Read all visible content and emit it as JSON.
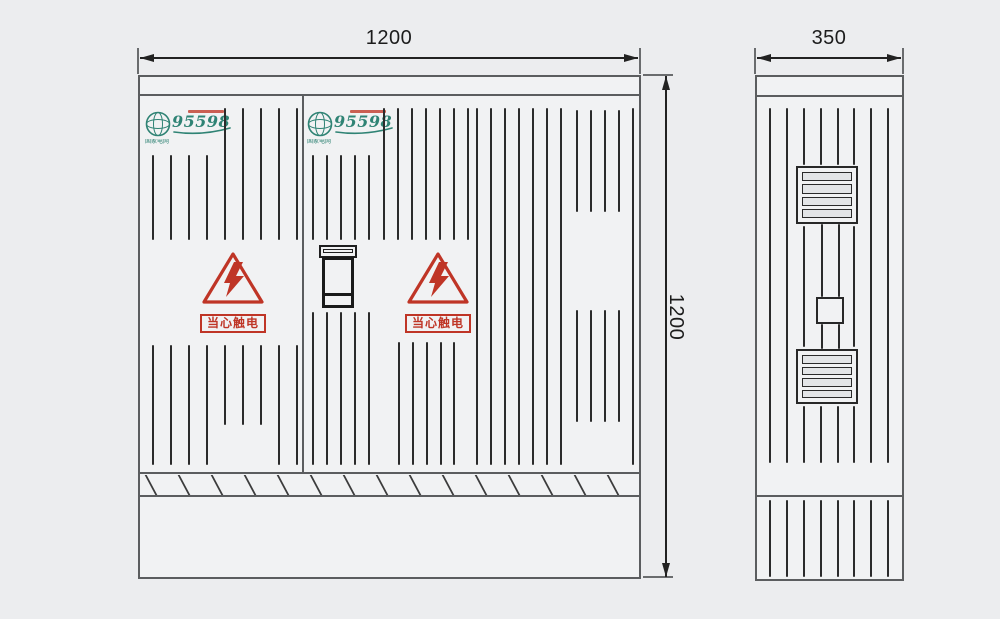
{
  "colors": {
    "background": "#ecedef",
    "panel_fill": "#f1f2f3",
    "line": "#3c3c3c",
    "slot": "#2b2b2b",
    "logo_teal": "#2f8374",
    "warning_red": "#bf3526",
    "dim_text": "#1c1c1c"
  },
  "dimensions": {
    "front_width": "1200",
    "front_height": "1200",
    "side_width": "350"
  },
  "logo": {
    "number": "95598",
    "brand": "国家电网"
  },
  "warning": {
    "text": "当心触电"
  },
  "front_view": {
    "slot_groups": [
      {
        "xs": [
          152,
          170,
          188,
          206
        ],
        "y1": 155,
        "y2": 240
      },
      {
        "xs": [
          224,
          242,
          260,
          278,
          296
        ],
        "y1": 108,
        "y2": 240
      },
      {
        "xs": [
          152,
          170,
          188,
          206
        ],
        "y1": 345,
        "y2": 465
      },
      {
        "xs": [
          224,
          242,
          260
        ],
        "y1": 345,
        "y2": 425
      },
      {
        "xs": [
          278,
          296
        ],
        "y1": 345,
        "y2": 465
      },
      {
        "xs": [
          312,
          326,
          340,
          354,
          368
        ],
        "y1": 155,
        "y2": 240
      },
      {
        "xs": [
          312,
          326,
          340,
          354,
          368
        ],
        "y1": 312,
        "y2": 465
      },
      {
        "xs": [
          383,
          397,
          411,
          425,
          439,
          453,
          467
        ],
        "y1": 108,
        "y2": 240
      },
      {
        "xs": [
          398,
          412,
          426,
          440,
          453
        ],
        "y1": 342,
        "y2": 465
      },
      {
        "xs": [
          476,
          490,
          504,
          518,
          532,
          546,
          560
        ],
        "y1": 108,
        "y2": 465
      },
      {
        "xs": [
          576,
          590,
          604,
          618
        ],
        "y1": 110,
        "y2": 212
      },
      {
        "xs": [
          576,
          590,
          604,
          618
        ],
        "y1": 310,
        "y2": 422
      },
      {
        "xs": [
          632
        ],
        "y1": 108,
        "y2": 465
      }
    ],
    "hatch": {
      "x_start": 150,
      "step": 33,
      "count": 15,
      "y": 475,
      "h": 20
    }
  },
  "side_view": {
    "slot_groups": [
      {
        "xs": [
          769,
          786,
          870,
          887
        ],
        "y1": 108,
        "y2": 463
      },
      {
        "xs": [
          803,
          820,
          837,
          853
        ],
        "y1": 108,
        "y2": 165
      },
      {
        "xs": [
          803,
          853
        ],
        "y1": 226,
        "y2": 347
      },
      {
        "xs": [
          803,
          820,
          837,
          853
        ],
        "y1": 406,
        "y2": 463
      },
      {
        "xs": [
          821,
          838
        ],
        "y1": 224,
        "y2": 297
      },
      {
        "xs": [
          821,
          838
        ],
        "y1": 324,
        "y2": 349
      },
      {
        "xs": [
          769,
          786,
          803,
          820,
          837,
          853,
          870,
          887
        ],
        "y1": 500,
        "y2": 577
      }
    ],
    "louvers": [
      {
        "x": 796,
        "y": 166,
        "w": 62,
        "h": 58,
        "slats": 4
      },
      {
        "x": 796,
        "y": 349,
        "w": 62,
        "h": 55,
        "slats": 4
      }
    ],
    "connector_box": {
      "x": 816,
      "y": 297,
      "w": 28,
      "h": 27
    }
  }
}
